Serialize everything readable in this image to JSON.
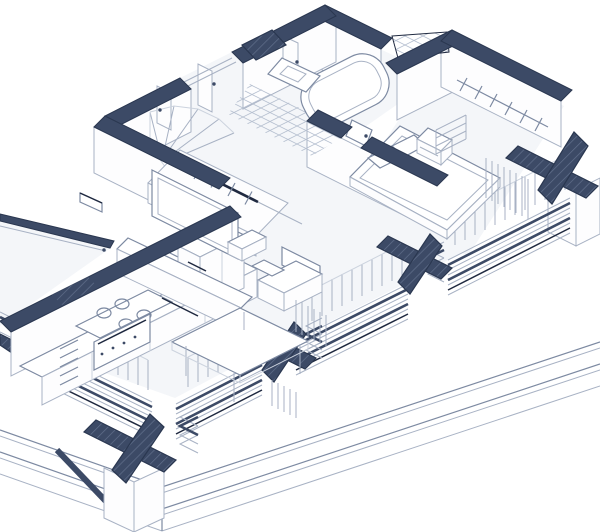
{
  "title": "Axonometric cutaway floor plan of a small apartment",
  "drawing_type": "architectural isometric section-perspective",
  "colors": {
    "paper": "#ffffff",
    "floor": "#f4f6f9",
    "wallface": "#fdfdfe",
    "navy": "#3c4a66",
    "navyDeep": "#2a3750",
    "ink": "#1f2940",
    "lineLight": "#a8b2c4",
    "lineMid": "#7d8aa2",
    "lineFaint": "#ccd3de",
    "tile": "#b6c0d0",
    "hatch": "#61708c"
  },
  "rooms": [
    {
      "name": "bathroom",
      "items": [
        "bathtub",
        "vanity-sink",
        "diamond-tile-floor",
        "door"
      ]
    },
    {
      "name": "bedroom",
      "items": [
        "double-bed",
        "pillows",
        "nightstand",
        "wardrobe-rail-with-hangers",
        "shelf-stack",
        "curtain"
      ]
    },
    {
      "name": "entry-hall",
      "items": [
        "winder-stairs",
        "coat-closet-rail-with-hangers"
      ]
    },
    {
      "name": "kitchen",
      "items": [
        "cooktop-4-burners",
        "oven",
        "sink-with-faucet",
        "drawer-stack",
        "tall-cabinet",
        "counter"
      ]
    },
    {
      "name": "living-room",
      "items": [
        "tv",
        "tv-console",
        "armchair",
        "side-table",
        "dining-table",
        "curtains"
      ]
    },
    {
      "name": "balcony",
      "items": [
        "parapet",
        "doormat"
      ]
    }
  ],
  "structure": [
    "navy wall caps",
    "hatched cut columns",
    "plus-shaped column capitals",
    "stepped floor-slab layers",
    "window mullions",
    "plinth base with cornices"
  ]
}
